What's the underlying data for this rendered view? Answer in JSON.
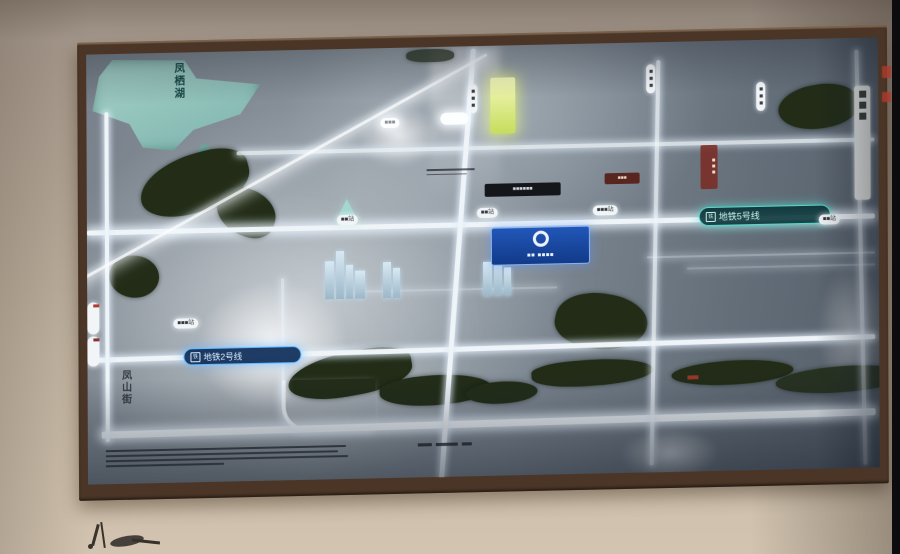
{
  "map": {
    "lake_label": "凤栖湖",
    "street_label": "凤山街",
    "metro5": {
      "label": "地铁5号线",
      "icon": "铁",
      "color": "#56d8cc"
    },
    "metro2": {
      "label": "地铁2号线",
      "icon": "铁",
      "color": "#63b9ff"
    },
    "badge": {
      "text": "■■ ■■■■",
      "logo": "ring"
    },
    "stations": [
      {
        "label": "■■站"
      },
      {
        "label": "■■站"
      },
      {
        "label": "■■■站"
      },
      {
        "label": "■■站"
      },
      {
        "label": "■■■站"
      },
      {
        "label": "■■■"
      }
    ],
    "road_pills": [
      {
        "label": "■■■"
      },
      {
        "label": "■■■"
      },
      {
        "label": "■■■"
      }
    ],
    "banners": {
      "dark": "■■■■■■",
      "red": "■■■",
      "red_vertical": "■■■"
    },
    "colors": {
      "badge_bg": "#16429a",
      "lake": "#8fc3bd",
      "park": "#222c17",
      "road_glow": "#ffffff",
      "frame_wood": "#4a3526"
    }
  }
}
